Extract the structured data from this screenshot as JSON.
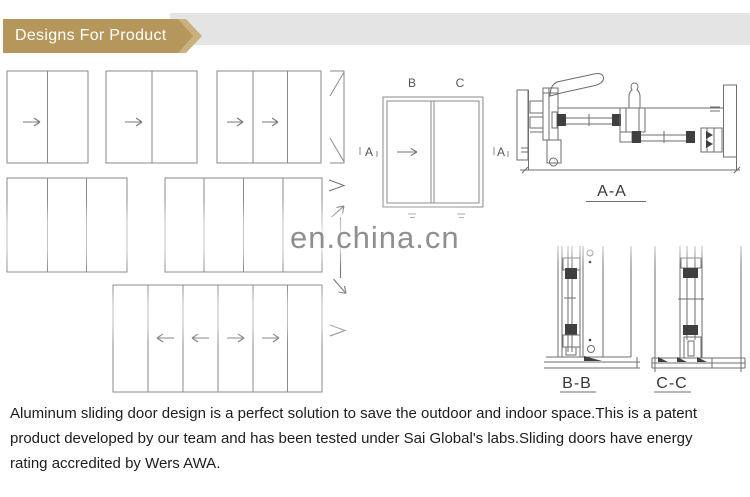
{
  "header": {
    "banner_label": "Designs For Product"
  },
  "watermark": {
    "text": "en.china.cn"
  },
  "diagrams": {
    "elevation_labels": {
      "left": "A",
      "right": "A",
      "panel_left": "B",
      "panel_right": "C"
    },
    "section_labels": {
      "horizontal": "A-A",
      "left_vertical": "B-B",
      "right_vertical": "C-C"
    }
  },
  "description": {
    "lines": [
      "Aluminum sliding door design is a perfect solution to save the outdoor and indoor space.This is a patent",
      "product developed by our team and has been tested under Sai Global's labs.Sliding doors have energy",
      "rating accredited by Wers AWA."
    ]
  },
  "colors": {
    "banner_gold": "#b5975c",
    "banner_gold_light": "#c9b07c",
    "strip_gray": "#e4e4e4",
    "line_gray": "#8a8a8a",
    "watermark_gray": "#8f8f8f"
  }
}
